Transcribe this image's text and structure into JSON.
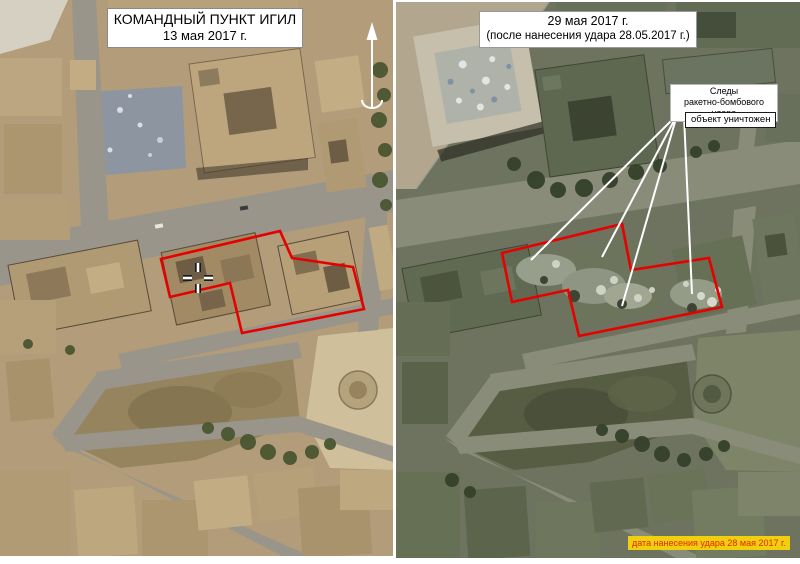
{
  "before_panel": {
    "title": "КОМАНДНЫЙ ПУНКТ ИГИЛ",
    "date": "13 мая 2017 г."
  },
  "after_panel": {
    "date": "29 мая 2017 г.",
    "subtitle": "(после нанесения удара 28.05.2017 г.)",
    "strike_label_line1": "Следы",
    "strike_label_line2": "ракетно-бомбового удара",
    "destroyed_label": "объект уничтожен",
    "strike_date_label": "дата нанесения удара 28 мая 2017 г."
  },
  "colors": {
    "target_outline": "#e60000",
    "pointer_lines": "#ffffff",
    "strike_date_bg": "#f2cf0e",
    "strike_date_text": "#e02800",
    "annotation_bg": "#ffffff",
    "annotation_text": "#000000"
  },
  "icons": {
    "north_arrow": "↑",
    "crosshair_cursor": "+"
  }
}
